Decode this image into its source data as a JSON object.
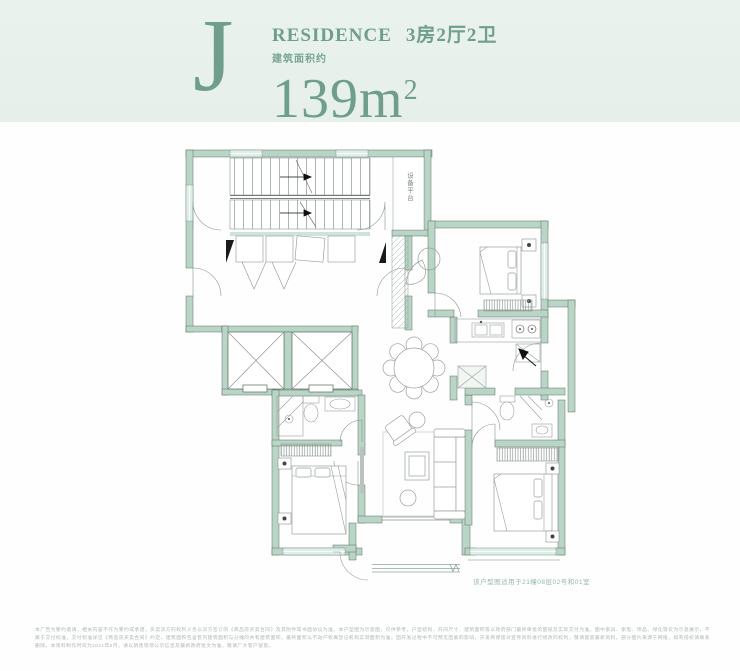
{
  "header": {
    "unit_letter": "J",
    "residence_label": "RESIDENCE",
    "layout_label": "3房2厅2卫",
    "area_prefix": "建筑面积约",
    "area_number": "139m",
    "area_superscript": "2"
  },
  "plan": {
    "equipment_platform_label": "设备平台",
    "floor_note": "该户型图适用于21幢08层02号和01室"
  },
  "colors": {
    "accent_green": "#6f9e8c",
    "wall_green": "#b9d5c6",
    "band_background": "#e8f1ec",
    "note_green": "#96b9aa"
  },
  "disclaimer": {
    "text": "本广告为要约邀请，相关内容不作为要约或承诺，买卖双方的权利义务以双方签订的《商品房买卖合同》及其附件等书面协议为准。本户型图为示意图，仅供参考，户型结构、开间尺寸、建筑面积等以政府部门最终审批的图纸及实际交付为准。图中家具、家电、饰品、绿化等仅为示意展示，不属于交付标准，交付标准详见《商品房买卖合同》约定。建筑面积包含套内建筑面积与分摊的共有建筑面积，最终面积以不动产权属登记机构实测面积为准。因开发过程中不可预见因素的影响，开发商保留对宣传资料进行修改的权利，敬请留意最新资料。部分图片来源于网络，如有侵权请联系删除。本资料制作时间为2021年8月，请以销售现场公示信息及最新政府批文为准，敬请广大客户留意。"
  }
}
